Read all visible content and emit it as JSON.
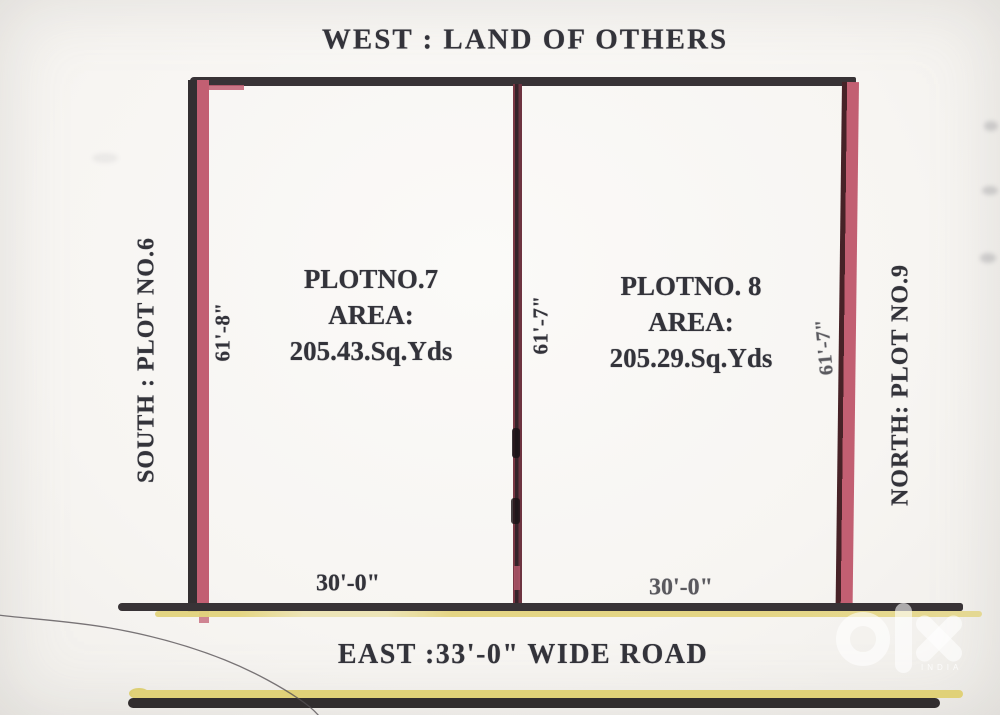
{
  "diagram": {
    "west_label": "WEST : LAND OF OTHERS",
    "east_label": "EAST :33'-0\" WIDE ROAD",
    "south_label": "SOUTH : PLOT NO.6",
    "north_label": "NORTH: PLOT NO.9",
    "plot7": {
      "name": "PLOTNO.7",
      "area_label": "AREA:",
      "area_value": "205.43.Sq.Yds",
      "frontage": "30'-0\"",
      "side_length": "61'-8\""
    },
    "plot8": {
      "name": "PLOTNO. 8",
      "area_label": "AREA:",
      "area_value": "205.29.Sq.Yds",
      "frontage": "30'-0\"",
      "side_length": "61'-7\""
    },
    "divider_length": "61'-7\"",
    "colors": {
      "ink": "#33333a",
      "outline_black": "#383336",
      "boundary_pink": "#c25f72",
      "road_yellow": "#e2d37c",
      "divider_maroon": "#35242a"
    }
  },
  "watermark": {
    "brand": "olx",
    "country": "INDIA"
  }
}
